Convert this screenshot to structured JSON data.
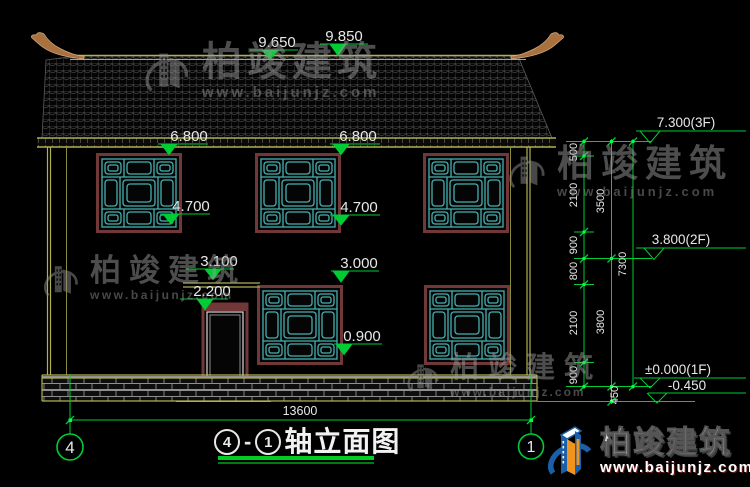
{
  "title": {
    "axis_left": "4",
    "separator": "-",
    "axis_right": "1",
    "name": "轴立面图"
  },
  "grid": {
    "left_bubble": "4",
    "right_bubble": "1"
  },
  "dimensions": {
    "ridge": "9.850",
    "eave": "9.650",
    "f2_win_top_l": "6.800",
    "f2_win_top_r": "6.800",
    "f2_sill_l": "4.700",
    "f2_sill_r": "4.700",
    "lintel": "3.100",
    "door_top": "2.200",
    "f1_win_top": "3.000",
    "f1_sill": "0.900",
    "total_width": "13600",
    "chain_inner": [
      "500",
      "2100",
      "900",
      "800",
      "2100",
      "900"
    ],
    "chain_mid": [
      "3500",
      "3800",
      "450"
    ],
    "chain_outer": [
      "7300"
    ]
  },
  "levels": {
    "f3": "7.300(3F)",
    "f2": "3.800(2F)",
    "f1": "±0.000(1F)",
    "ground": "-0.450"
  },
  "watermark": {
    "company": "柏竣建筑",
    "url": "www.baijunjz.com"
  },
  "brand_logo": {
    "company": "柏竣建筑",
    "url": "www.baijunjz.com"
  },
  "colors": {
    "dim_green": "#00cc33",
    "lattice_teal": "#45b0b0",
    "frame_maroon": "#703838",
    "outline_yellow": "#b0b050",
    "text_white": "#e8e8e8",
    "brand_blue": "#1a5fa8",
    "brand_orange": "#f0941e"
  }
}
